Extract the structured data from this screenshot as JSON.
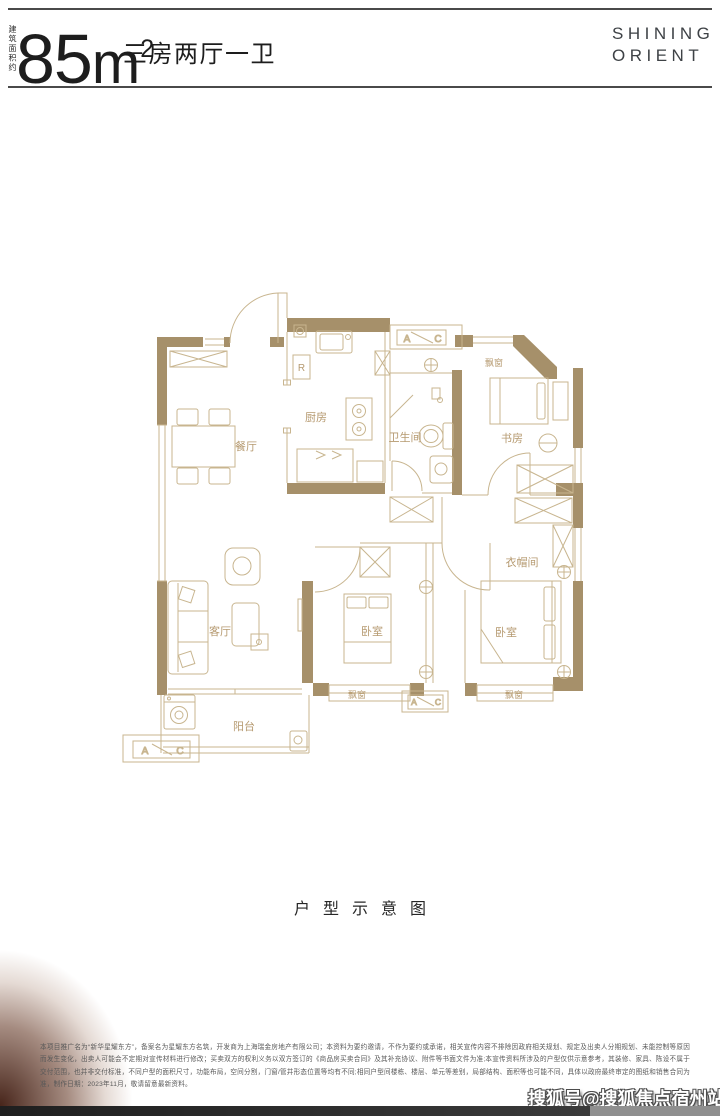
{
  "header": {
    "area_label_vertical": "建筑面积约",
    "area_number": "85",
    "area_unit_m": "m",
    "area_unit_sup": "2",
    "title": "三房两厅一卫",
    "brand": {
      "line1": "SHINING",
      "line2": "ORIENT"
    }
  },
  "floorplan": {
    "rooms": {
      "dining": "餐厅",
      "kitchen": "厨房",
      "bathroom": "卫生间",
      "study": "书房",
      "living": "客厅",
      "bedroom_mid": "卧室",
      "bedroom_right": "卧室",
      "closet": "衣帽间",
      "balcony": "阳台",
      "bay_top": "飘窗",
      "bay_mid": "飘窗",
      "bay_right": "飘窗"
    },
    "markers": {
      "fridge": "R",
      "ac_a": "A",
      "ac_c": "C"
    }
  },
  "caption": "户型示意图",
  "disclaimer": {
    "lines": [
      "本项目推广名为“新华星耀东方”，备案名为星耀东方名筑，开发商为上海瑞金房地产有限公司；本资料为要约邀请，不作为要约或承诺，相关宣传内容不排除因政府相关规划、规定及出卖人分期规划、未能控制等原因而发生变",
      "化，出卖人可能会不定期对宣传材料进行修改；买卖双方的权利义务以双方签订的《商品房买卖合同》及其补充协议、附件等书面文件为准;本宣传资料所涉及的户型仅供示意参考，其装修、家具、陈设不属于交付范围，也并",
      "非交付标准，不同户型的面积尺寸，功能布局，空间分割，门窗/管井形态位置等均有不同;相同户型间楼栋、楼层、单元等差别，局部结构、面积等也可能不同，具体以政府最终审定的图纸和销售合同为准，制作日期：2023年",
      "11月，敬请留意最新资料。"
    ]
  },
  "watermark": "搜狐号@搜狐焦点宿州站",
  "colors": {
    "wall": "#a6906a",
    "line": "#c8b58f",
    "label": "#b69a70",
    "heading": "#1d1d1d",
    "brand": "#3e4246",
    "disclaimer": "#595959",
    "strip_dark": "#2b2b2b",
    "strip_light": "#8f8f8f"
  }
}
